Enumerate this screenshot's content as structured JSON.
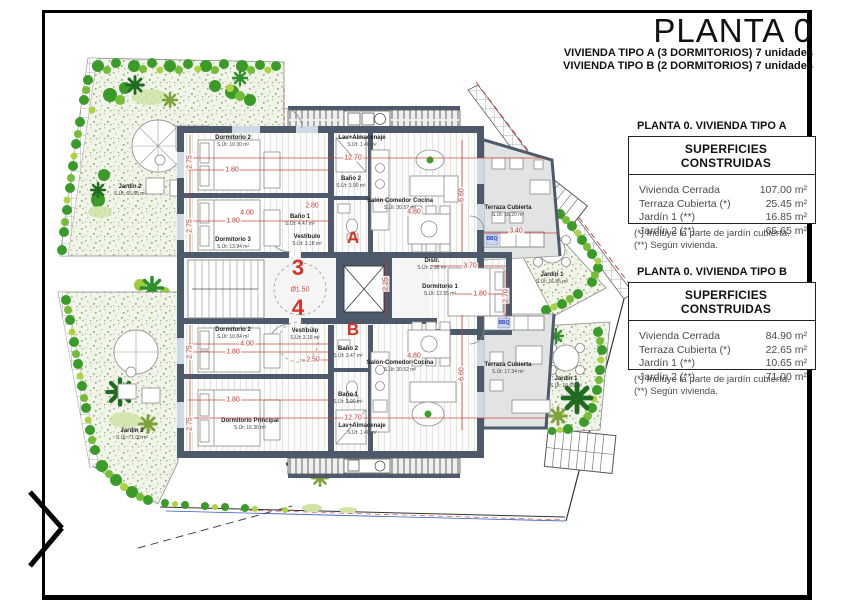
{
  "header": {
    "title": "PLANTA 0",
    "subtitles": [
      "VIVIENDA TIPO A (3 DORMITORIOS) 7 unidades",
      "VIVIENDA TIPO B (2 DORMITORIOS) 7 unidades"
    ]
  },
  "legends": [
    {
      "heading": "PLANTA 0. VIVIENDA TIPO A",
      "table_title": "SUPERFICIES CONSTRUIDAS",
      "rows": [
        {
          "label": "Vivienda Cerrada",
          "value": "107.00 m²"
        },
        {
          "label": "Terraza Cubierta  (*)",
          "value": "25.45 m²"
        },
        {
          "label": "Jardín 1 (**)",
          "value": "16.85 m²"
        },
        {
          "label": "Jardín 2 (**)",
          "value": "65.65 m²"
        }
      ],
      "notes": [
        "(*)  Incluye la parte de jardín cubierta.",
        "(**) Según vivienda."
      ]
    },
    {
      "heading": "PLANTA 0. VIVIENDA TIPO B",
      "table_title": "SUPERFICIES CONSTRUIDAS",
      "rows": [
        {
          "label": "Vivienda Cerrada",
          "value": "84.90 m²"
        },
        {
          "label": "Terraza Cubierta (*)",
          "value": "22.65 m²"
        },
        {
          "label": "Jardín 1 (**)",
          "value": "10.65 m²"
        },
        {
          "label": "Jardín 2 (**)",
          "value": "71.00 m²"
        }
      ],
      "notes": [
        "(*) Incluye la parte de jardín cubierta.",
        "(**) Según vivienda."
      ]
    }
  ],
  "plan": {
    "colors": {
      "wall": "#4d5a6c",
      "dim_red": "#cf3a2a",
      "hedge_green": "#3a9b28",
      "terrace_gray": "#e2e4e3",
      "bbq_blue": "#2d3fc0"
    },
    "unit_marks": [
      {
        "text": "A",
        "x": 353,
        "y": 238,
        "k": "letter"
      },
      {
        "text": "B",
        "x": 353,
        "y": 330,
        "k": "letter"
      },
      {
        "text": "3",
        "x": 298,
        "y": 268,
        "k": "number"
      },
      {
        "text": "4",
        "x": 298,
        "y": 308,
        "k": "number"
      }
    ],
    "bbq_labels": [
      {
        "text": "BBQ",
        "x": 492,
        "y": 239
      },
      {
        "text": "BBQ",
        "x": 504,
        "y": 323
      }
    ],
    "room_labels": [
      {
        "title": "Dormitorio 2",
        "area": "S.Út: 10.30 m²",
        "x": 233,
        "y": 141
      },
      {
        "title": "Dormitorio 3",
        "area": "S.Út: 13.94 m²",
        "x": 233,
        "y": 243
      },
      {
        "title": "Baño 2",
        "area": "S.Út: 3.90 m²",
        "x": 351,
        "y": 182
      },
      {
        "title": "Baño 1",
        "area": "S.Út: 4.47 m²",
        "x": 300,
        "y": 220
      },
      {
        "title": "Vestíbulo",
        "area": "S.Út: 3.18 m²",
        "x": 307,
        "y": 240
      },
      {
        "title": "Lav+Almacenaje",
        "area": "S.Út: 1.40 m²",
        "x": 362,
        "y": 141
      },
      {
        "title": "Salón Comedor Cocina",
        "area": "S.Út: 30.52 m²",
        "x": 400,
        "y": 204
      },
      {
        "title": "Terraza Cubierta",
        "area": "S.Út: 16.20 m²",
        "x": 508,
        "y": 211
      },
      {
        "title": "Distr.",
        "area": "S.Út: 2.96 m²",
        "x": 432,
        "y": 264
      },
      {
        "title": "Dormitorio 1",
        "area": "S.Út: 12.55 m²",
        "x": 440,
        "y": 290
      },
      {
        "title": "Jardín 2",
        "area": "S.Út: 65.65 m²",
        "x": 130,
        "y": 190
      },
      {
        "title": "Jardín 1",
        "area": "S.Út: 16.85 m²",
        "x": 552,
        "y": 278
      },
      {
        "title": "Dormitorio 2",
        "area": "S.Út: 10.84 m²",
        "x": 233,
        "y": 333
      },
      {
        "title": "Vestíbulo",
        "area": "S.Út: 3.16 m²",
        "x": 305,
        "y": 334
      },
      {
        "title": "Baño 2",
        "area": "S.Út: 3.47 m²",
        "x": 348,
        "y": 352
      },
      {
        "title": "Baño 1",
        "area": "S.Út: 3.90 m²",
        "x": 348,
        "y": 398
      },
      {
        "title": "Dormitorio Principal",
        "area": "S.Út: 16.30 m²",
        "x": 250,
        "y": 424
      },
      {
        "title": "Lav+Almacenaje",
        "area": "S.Út: 1.40 m²",
        "x": 362,
        "y": 429
      },
      {
        "title": "Salón-Comedor-Cocina",
        "area": "S.Út: 30.52 m²",
        "x": 400,
        "y": 366
      },
      {
        "title": "Terraza Cubierta",
        "area": "S.Út: 17.34 m²",
        "x": 508,
        "y": 368
      },
      {
        "title": "Jardín 2",
        "area": "S.Út: 71.00 m²",
        "x": 132,
        "y": 434
      },
      {
        "title": "Jardín 1",
        "area": "S.Út: 10.65 m²",
        "x": 566,
        "y": 382
      }
    ],
    "dims": [
      {
        "text": "12.70",
        "x": 353,
        "y": 158
      },
      {
        "text": "1.80",
        "x": 232,
        "y": 170
      },
      {
        "text": "4.00",
        "x": 247,
        "y": 213
      },
      {
        "text": "1.80",
        "x": 233,
        "y": 221
      },
      {
        "text": "2.75",
        "x": 190,
        "y": 162,
        "rot": 90
      },
      {
        "text": "2.75",
        "x": 190,
        "y": 226,
        "rot": 90
      },
      {
        "text": "2.80",
        "x": 312,
        "y": 206
      },
      {
        "text": "4.80",
        "x": 414,
        "y": 212
      },
      {
        "text": "6.60",
        "x": 462,
        "y": 195,
        "rot": 90
      },
      {
        "text": "3.40",
        "x": 516,
        "y": 231
      },
      {
        "text": "3.70",
        "x": 470,
        "y": 266
      },
      {
        "text": "1.80",
        "x": 480,
        "y": 294
      },
      {
        "text": "2.70",
        "x": 506,
        "y": 296,
        "rot": 90
      },
      {
        "text": "2.25",
        "x": 386,
        "y": 284,
        "rot": 90
      },
      {
        "text": "Ø1.50",
        "x": 300,
        "y": 290
      },
      {
        "text": "2.50",
        "x": 313,
        "y": 360
      },
      {
        "text": "4.00",
        "x": 247,
        "y": 344
      },
      {
        "text": "1.80",
        "x": 233,
        "y": 352
      },
      {
        "text": "1.80",
        "x": 233,
        "y": 400
      },
      {
        "text": "2.75",
        "x": 190,
        "y": 352,
        "rot": 90
      },
      {
        "text": "2.75",
        "x": 190,
        "y": 424,
        "rot": 90
      },
      {
        "text": "12.70",
        "x": 353,
        "y": 418
      },
      {
        "text": "4.80",
        "x": 414,
        "y": 356
      },
      {
        "text": "6.60",
        "x": 462,
        "y": 374,
        "rot": 90
      }
    ]
  }
}
